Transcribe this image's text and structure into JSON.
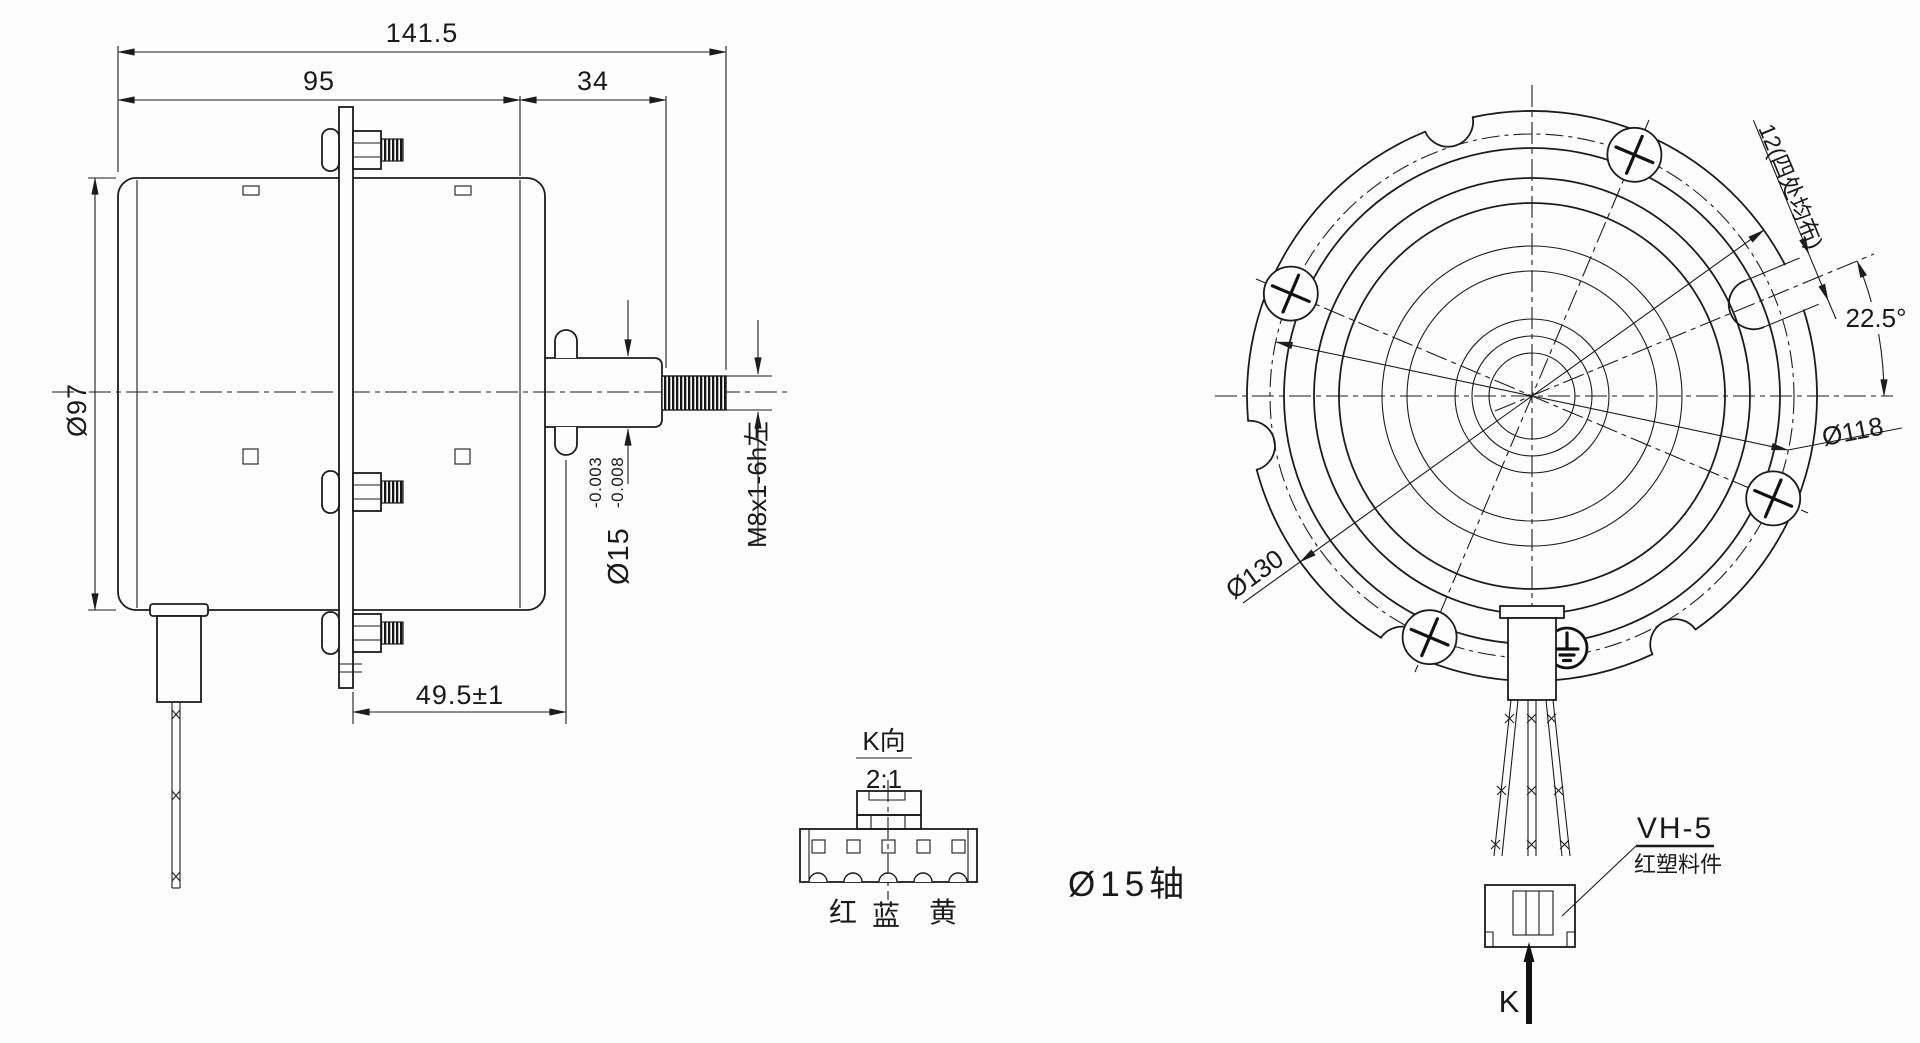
{
  "side_view": {
    "dim_overall": "141.5",
    "dim_body": "95",
    "dim_front": "34",
    "dim_diameter": "Ø97",
    "dim_plate_to_shaft": "49.5±1",
    "shaft_dim": {
      "main": "Ø15",
      "tol_upper": "-0.003",
      "tol_lower": "-0.008"
    },
    "thread_spec": "M8x1-6h左"
  },
  "detail_view": {
    "title": "K向",
    "scale": "2:1",
    "wire_labels": [
      "红",
      "蓝",
      "黄"
    ],
    "note": "Ø15轴"
  },
  "front_view": {
    "slot_note": "12(四处均布)",
    "angle": "22.5°",
    "bolt_circle": "Ø118",
    "outer_diameter": "Ø130",
    "connector": {
      "model": "VH-5",
      "material": "红塑料件"
    },
    "view_label": "K"
  }
}
